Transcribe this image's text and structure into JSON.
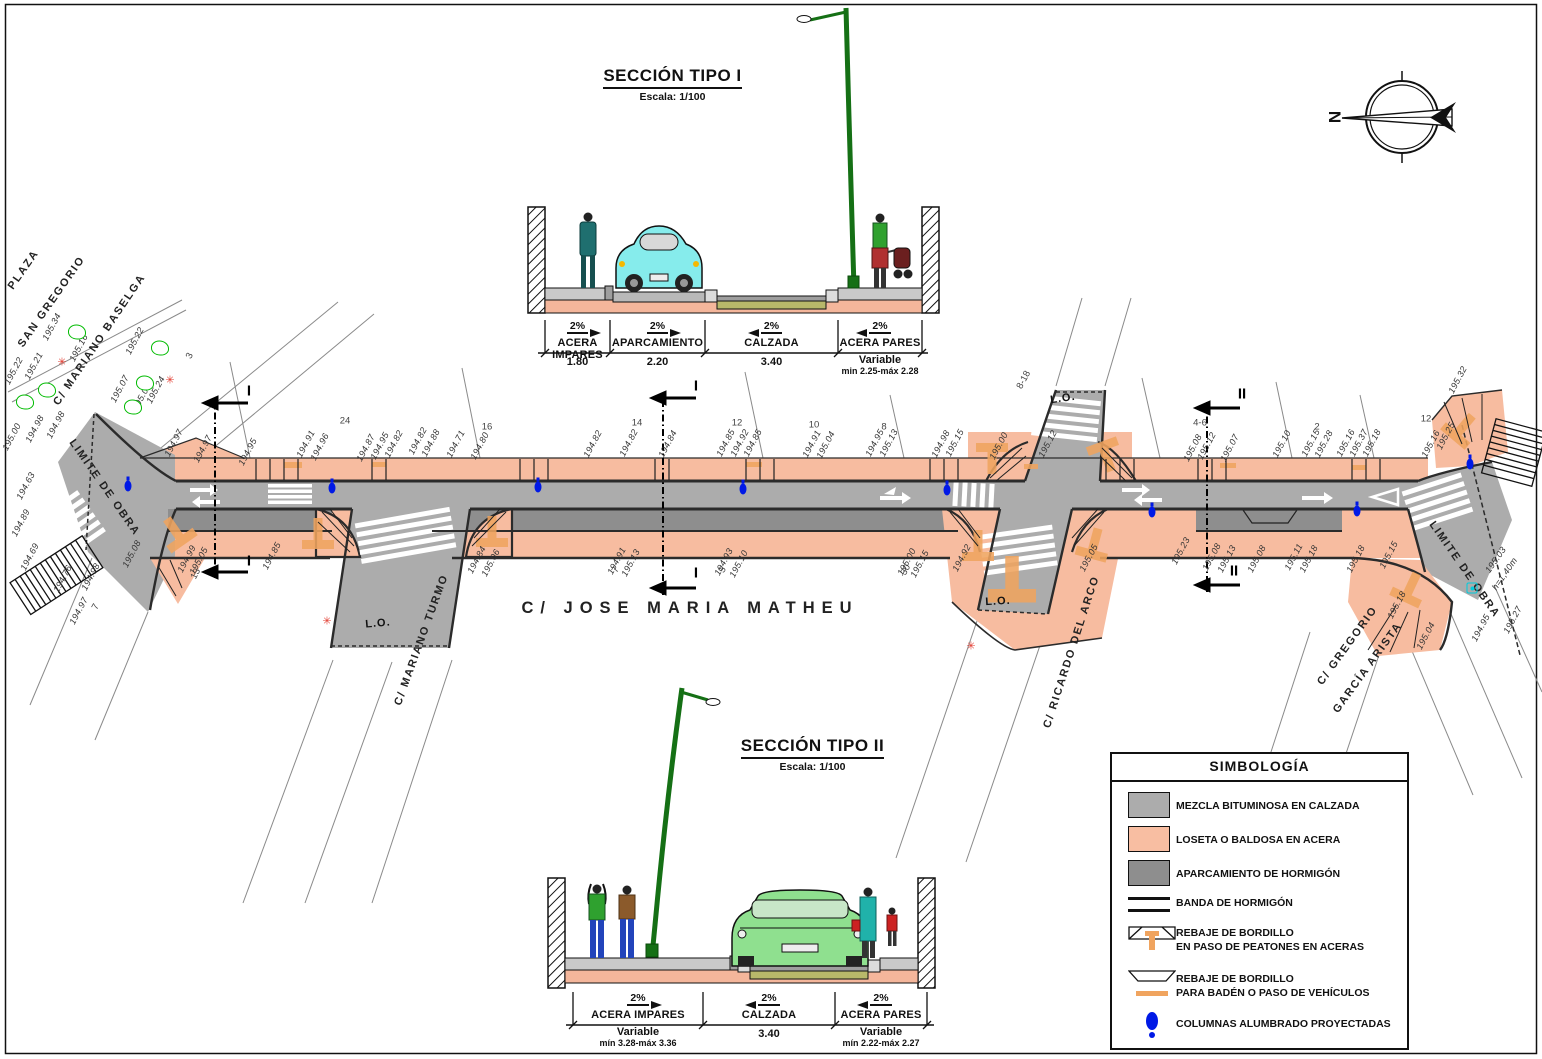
{
  "compass": {
    "letter": "N"
  },
  "colors": {
    "sidewalk": "#F7BCA0",
    "road": "#ACACAC",
    "parking": "#8E8E8E",
    "curb_cut_orange": "#F0A45F",
    "lamp_blue": "#0019E6",
    "tree_green": "#00BB00",
    "burst_red": "#E23A2E",
    "hydrant_cyan": "#00CCDD",
    "road_bed_olive": "#B8B86A"
  },
  "section1": {
    "title": "SECCIÓN TIPO I",
    "scale": "Escala: 1/100",
    "segments": [
      {
        "slope": "2%",
        "label": "ACERA IMPARES",
        "dim": "1.80"
      },
      {
        "slope": "2%",
        "label": "APARCAMIENTO",
        "dim": "2.20"
      },
      {
        "slope": "2%",
        "label": "CALZADA",
        "dim": "3.40"
      },
      {
        "slope": "2%",
        "label": "ACERA PARES",
        "dim": "Variable",
        "dim2": "min 2.25-máx 2.28"
      }
    ]
  },
  "section2": {
    "title": "SECCIÓN TIPO II",
    "scale": "Escala: 1/100",
    "segments": [
      {
        "slope": "2%",
        "label": "ACERA IMPARES",
        "dim": "Variable",
        "dim2": "mín 3.28-máx 3.36"
      },
      {
        "slope": "2%",
        "label": "CALZADA",
        "dim": "3.40"
      },
      {
        "slope": "2%",
        "label": "ACERA PARES",
        "dim": "Variable",
        "dim2": "mín 2.22-máx 2.27"
      }
    ]
  },
  "legend": {
    "title": "SIMBOLOGÍA",
    "items": [
      {
        "symbol": "road-swatch",
        "label": "MEZCLA BITUMINOSA EN CALZADA"
      },
      {
        "symbol": "sidewalk-swatch",
        "label": "LOSETA O BALDOSA EN ACERA"
      },
      {
        "symbol": "parking-swatch",
        "label": "APARCAMIENTO DE HORMIGÓN"
      },
      {
        "symbol": "band-swatch",
        "label": "BANDA DE HORMIGÓN"
      },
      {
        "symbol": "curb-ped-swatch",
        "label": "REBAJE DE BORDILLO",
        "label2": "EN PASO DE PEATONES EN ACERAS"
      },
      {
        "symbol": "curb-veh-swatch",
        "label": "REBAJE DE BORDILLO",
        "label2": "PARA BADÉN O PASO DE VEHÍCULOS"
      },
      {
        "symbol": "lamp-swatch",
        "label": "COLUMNAS ALUMBRADO PROYECTADAS"
      }
    ]
  },
  "plan": {
    "labels": [
      {
        "t": "PLAZA",
        "x": 24,
        "y": 270,
        "r": -55,
        "c": "street",
        "n": "street-label-plaza"
      },
      {
        "t": "SAN GREGORIO",
        "x": 52,
        "y": 302,
        "r": -55,
        "c": "street",
        "n": "street-label-san-gregorio"
      },
      {
        "t": "C/ MARIANO BASELGA",
        "x": 100,
        "y": 340,
        "r": -56,
        "c": "street",
        "n": "street-label-mariano-baselga"
      },
      {
        "t": "LIMITE DE OBRA",
        "x": 104,
        "y": 488,
        "r": 55,
        "c": "street",
        "n": "limite-de-obra-left"
      },
      {
        "t": "C/ MARIANO TURMO",
        "x": 422,
        "y": 640,
        "r": -70,
        "c": "street",
        "n": "street-label-mariano-turmo"
      },
      {
        "t": "C/  JOSE  MARIA  MATHEU",
        "x": 690,
        "y": 608,
        "r": 0,
        "c": "main-street",
        "n": "street-label-jose-maria-matheu"
      },
      {
        "t": "C/ RICARDO DEL ARCO",
        "x": 1072,
        "y": 652,
        "r": -72,
        "c": "street",
        "n": "street-label-ricardo-del-arco"
      },
      {
        "t": "C/ GREGORIO",
        "x": 1348,
        "y": 646,
        "r": -54,
        "c": "street",
        "n": "street-label-gregorio"
      },
      {
        "t": "GARCÍA ARISTA",
        "x": 1368,
        "y": 668,
        "r": -54,
        "c": "street",
        "n": "street-label-garcia-arista"
      },
      {
        "t": "LIMITE DE OBRA",
        "x": 1464,
        "y": 570,
        "r": 55,
        "c": "street",
        "n": "limite-de-obra-right"
      },
      {
        "t": "L.O.",
        "x": 378,
        "y": 624,
        "r": -5,
        "c": "lo"
      },
      {
        "t": "L.O.",
        "x": 1063,
        "y": 399,
        "r": -8,
        "c": "lo"
      },
      {
        "t": "L.O.",
        "x": 998,
        "y": 602,
        "r": -3,
        "c": "lo"
      },
      {
        "t": "I",
        "x": 249,
        "y": 391,
        "r": 0,
        "c": "mark",
        "n": "section-cut-mark-1"
      },
      {
        "t": "I",
        "x": 249,
        "y": 561,
        "r": 0,
        "c": "mark",
        "n": "section-cut-mark-1"
      },
      {
        "t": "I",
        "x": 696,
        "y": 386,
        "r": 0,
        "c": "mark",
        "n": "section-cut-mark-1"
      },
      {
        "t": "I",
        "x": 696,
        "y": 573,
        "r": 0,
        "c": "mark",
        "n": "section-cut-mark-1"
      },
      {
        "t": "II",
        "x": 1242,
        "y": 394,
        "r": 0,
        "c": "mark",
        "n": "section-cut-mark-2"
      },
      {
        "t": "II",
        "x": 1234,
        "y": 571,
        "r": 0,
        "c": "mark",
        "n": "section-cut-mark-2"
      },
      {
        "t": "24",
        "x": 345,
        "y": 421,
        "r": 0,
        "c": "num"
      },
      {
        "t": "16",
        "x": 487,
        "y": 427,
        "r": 0,
        "c": "num"
      },
      {
        "t": "14",
        "x": 637,
        "y": 423,
        "r": 0,
        "c": "num"
      },
      {
        "t": "12",
        "x": 737,
        "y": 423,
        "r": 0,
        "c": "num"
      },
      {
        "t": "10",
        "x": 814,
        "y": 425,
        "r": 0,
        "c": "num"
      },
      {
        "t": "8",
        "x": 884,
        "y": 427,
        "r": 0,
        "c": "num"
      },
      {
        "t": "4-6",
        "x": 1200,
        "y": 423,
        "r": 0,
        "c": "num"
      },
      {
        "t": "2",
        "x": 1317,
        "y": 427,
        "r": 0,
        "c": "num"
      },
      {
        "t": "12",
        "x": 1426,
        "y": 419,
        "r": 0,
        "c": "num"
      },
      {
        "t": "8-18",
        "x": 1024,
        "y": 380,
        "r": -62,
        "c": "num"
      },
      {
        "t": "3",
        "x": 190,
        "y": 356,
        "r": -62,
        "c": "num"
      },
      {
        "t": "13",
        "x": 196,
        "y": 574,
        "r": -62,
        "c": "num"
      },
      {
        "t": "7",
        "x": 96,
        "y": 607,
        "r": -62,
        "c": "num"
      },
      {
        "t": "7",
        "x": 616,
        "y": 570,
        "r": -62,
        "c": "num"
      },
      {
        "t": "5",
        "x": 723,
        "y": 570,
        "r": -62,
        "c": "num"
      },
      {
        "t": "30",
        "x": 906,
        "y": 570,
        "r": -62,
        "c": "num"
      },
      {
        "t": "194.97",
        "x": 174,
        "y": 443,
        "r": -62,
        "c": "elev"
      },
      {
        "t": "194.97",
        "x": 203,
        "y": 449,
        "r": -62,
        "c": "elev"
      },
      {
        "t": "194.95",
        "x": 248,
        "y": 452,
        "r": -62,
        "c": "elev"
      },
      {
        "t": "194.91",
        "x": 306,
        "y": 444,
        "r": -62,
        "c": "elev"
      },
      {
        "t": "194.96",
        "x": 320,
        "y": 447,
        "r": -62,
        "c": "elev"
      },
      {
        "t": "194.87",
        "x": 366,
        "y": 448,
        "r": -62,
        "c": "elev"
      },
      {
        "t": "194.95",
        "x": 380,
        "y": 446,
        "r": -62,
        "c": "elev"
      },
      {
        "t": "194.82",
        "x": 394,
        "y": 444,
        "r": -62,
        "c": "elev"
      },
      {
        "t": "194.82",
        "x": 418,
        "y": 441,
        "r": -62,
        "c": "elev"
      },
      {
        "t": "194.88",
        "x": 431,
        "y": 443,
        "r": -62,
        "c": "elev"
      },
      {
        "t": "194.71",
        "x": 456,
        "y": 444,
        "r": -62,
        "c": "elev"
      },
      {
        "t": "194.80",
        "x": 480,
        "y": 446,
        "r": -62,
        "c": "elev"
      },
      {
        "t": "194.82",
        "x": 593,
        "y": 444,
        "r": -62,
        "c": "elev"
      },
      {
        "t": "194.82",
        "x": 629,
        "y": 443,
        "r": -62,
        "c": "elev"
      },
      {
        "t": "194.84",
        "x": 668,
        "y": 444,
        "r": -62,
        "c": "elev"
      },
      {
        "t": "194.85",
        "x": 726,
        "y": 443,
        "r": -62,
        "c": "elev"
      },
      {
        "t": "194.92",
        "x": 740,
        "y": 443,
        "r": -62,
        "c": "elev"
      },
      {
        "t": "194.85",
        "x": 753,
        "y": 443,
        "r": -62,
        "c": "elev"
      },
      {
        "t": "194.91",
        "x": 812,
        "y": 444,
        "r": -62,
        "c": "elev"
      },
      {
        "t": "195.04",
        "x": 826,
        "y": 445,
        "r": -62,
        "c": "elev"
      },
      {
        "t": "194.95",
        "x": 875,
        "y": 443,
        "r": -62,
        "c": "elev"
      },
      {
        "t": "195.13",
        "x": 889,
        "y": 443,
        "r": -62,
        "c": "elev"
      },
      {
        "t": "194.98",
        "x": 941,
        "y": 444,
        "r": -62,
        "c": "elev"
      },
      {
        "t": "195.15",
        "x": 955,
        "y": 443,
        "r": -62,
        "c": "elev"
      },
      {
        "t": "195.00",
        "x": 999,
        "y": 446,
        "r": -62,
        "c": "elev"
      },
      {
        "t": "195.12",
        "x": 1048,
        "y": 444,
        "r": -62,
        "c": "elev"
      },
      {
        "t": "195.08",
        "x": 1193,
        "y": 448,
        "r": -62,
        "c": "elev"
      },
      {
        "t": "195.12",
        "x": 1207,
        "y": 446,
        "r": -62,
        "c": "elev"
      },
      {
        "t": "195.07",
        "x": 1230,
        "y": 448,
        "r": -62,
        "c": "elev"
      },
      {
        "t": "195.10",
        "x": 1282,
        "y": 444,
        "r": -62,
        "c": "elev"
      },
      {
        "t": "195.15",
        "x": 1311,
        "y": 443,
        "r": -62,
        "c": "elev"
      },
      {
        "t": "195.28",
        "x": 1324,
        "y": 444,
        "r": -62,
        "c": "elev"
      },
      {
        "t": "195.16",
        "x": 1346,
        "y": 443,
        "r": -62,
        "c": "elev"
      },
      {
        "t": "195.37",
        "x": 1359,
        "y": 443,
        "r": -62,
        "c": "elev"
      },
      {
        "t": "195.18",
        "x": 1372,
        "y": 443,
        "r": -62,
        "c": "elev"
      },
      {
        "t": "195.16",
        "x": 1431,
        "y": 444,
        "r": -62,
        "c": "elev"
      },
      {
        "t": "195.25",
        "x": 1446,
        "y": 436,
        "r": -62,
        "c": "elev"
      },
      {
        "t": "195.32",
        "x": 1458,
        "y": 380,
        "r": -62,
        "c": "elev"
      },
      {
        "t": "195.00",
        "x": 12,
        "y": 437,
        "r": -62,
        "c": "elev"
      },
      {
        "t": "194.98",
        "x": 35,
        "y": 429,
        "r": -62,
        "c": "elev"
      },
      {
        "t": "194.98",
        "x": 56,
        "y": 425,
        "r": -62,
        "c": "elev"
      },
      {
        "t": "195.22",
        "x": 14,
        "y": 371,
        "r": -62,
        "c": "elev"
      },
      {
        "t": "195.21",
        "x": 34,
        "y": 366,
        "r": -62,
        "c": "elev"
      },
      {
        "t": "195.34",
        "x": 52,
        "y": 327,
        "r": -62,
        "c": "elev"
      },
      {
        "t": "195.16",
        "x": 79,
        "y": 348,
        "r": -62,
        "c": "elev"
      },
      {
        "t": "195.22",
        "x": 135,
        "y": 341,
        "r": -62,
        "c": "elev"
      },
      {
        "t": "195.07",
        "x": 120,
        "y": 389,
        "r": -62,
        "c": "elev"
      },
      {
        "t": "195.06",
        "x": 142,
        "y": 397,
        "r": -62,
        "c": "elev"
      },
      {
        "t": "195.24",
        "x": 156,
        "y": 390,
        "r": -62,
        "c": "elev"
      },
      {
        "t": "194.63",
        "x": 26,
        "y": 486,
        "r": -62,
        "c": "elev"
      },
      {
        "t": "194.89",
        "x": 21,
        "y": 523,
        "r": -62,
        "c": "elev"
      },
      {
        "t": "194.69",
        "x": 30,
        "y": 557,
        "r": -62,
        "c": "elev"
      },
      {
        "t": "194.76",
        "x": 63,
        "y": 579,
        "r": -62,
        "c": "elev"
      },
      {
        "t": "194.98",
        "x": 91,
        "y": 577,
        "r": -62,
        "c": "elev"
      },
      {
        "t": "194.97",
        "x": 79,
        "y": 611,
        "r": -62,
        "c": "elev"
      },
      {
        "t": "195.08",
        "x": 132,
        "y": 554,
        "r": -62,
        "c": "elev"
      },
      {
        "t": "194.99",
        "x": 187,
        "y": 559,
        "r": -62,
        "c": "elev"
      },
      {
        "t": "195.05",
        "x": 199,
        "y": 561,
        "r": -62,
        "c": "elev"
      },
      {
        "t": "194.85",
        "x": 272,
        "y": 556,
        "r": -62,
        "c": "elev"
      },
      {
        "t": "194.84",
        "x": 477,
        "y": 560,
        "r": -62,
        "c": "elev"
      },
      {
        "t": "195.06",
        "x": 491,
        "y": 563,
        "r": -62,
        "c": "elev"
      },
      {
        "t": "194.91",
        "x": 617,
        "y": 561,
        "r": -62,
        "c": "elev"
      },
      {
        "t": "195.13",
        "x": 631,
        "y": 563,
        "r": -62,
        "c": "elev"
      },
      {
        "t": "194.93",
        "x": 724,
        "y": 562,
        "r": -62,
        "c": "elev"
      },
      {
        "t": "195.10",
        "x": 739,
        "y": 564,
        "r": -62,
        "c": "elev"
      },
      {
        "t": "195.00",
        "x": 907,
        "y": 562,
        "r": -62,
        "c": "elev"
      },
      {
        "t": "195.15",
        "x": 920,
        "y": 564,
        "r": -62,
        "c": "elev"
      },
      {
        "t": "194.92",
        "x": 962,
        "y": 558,
        "r": -62,
        "c": "elev"
      },
      {
        "t": "195.05",
        "x": 1089,
        "y": 558,
        "r": -62,
        "c": "elev"
      },
      {
        "t": "195.23",
        "x": 1181,
        "y": 551,
        "r": -62,
        "c": "elev"
      },
      {
        "t": "195.08",
        "x": 1212,
        "y": 557,
        "r": -62,
        "c": "elev"
      },
      {
        "t": "195.13",
        "x": 1227,
        "y": 559,
        "r": -62,
        "c": "elev"
      },
      {
        "t": "195.08",
        "x": 1257,
        "y": 559,
        "r": -62,
        "c": "elev"
      },
      {
        "t": "195.11",
        "x": 1294,
        "y": 557,
        "r": -62,
        "c": "elev"
      },
      {
        "t": "195.18",
        "x": 1309,
        "y": 559,
        "r": -62,
        "c": "elev"
      },
      {
        "t": "195.18",
        "x": 1356,
        "y": 559,
        "r": -62,
        "c": "elev"
      },
      {
        "t": "195.15",
        "x": 1389,
        "y": 555,
        "r": -62,
        "c": "elev"
      },
      {
        "t": "195.18",
        "x": 1397,
        "y": 605,
        "r": -62,
        "c": "elev"
      },
      {
        "t": "195.04",
        "x": 1426,
        "y": 636,
        "r": -62,
        "c": "elev"
      },
      {
        "t": "194.95",
        "x": 1481,
        "y": 628,
        "r": -62,
        "c": "elev"
      },
      {
        "t": "195.27",
        "x": 1513,
        "y": 620,
        "r": -62,
        "c": "elev"
      },
      {
        "t": "195.03",
        "x": 1496,
        "y": 560,
        "r": -55,
        "c": "elev",
        "n": "hydrant-elevation"
      },
      {
        "t": "h=1,40m",
        "x": 1505,
        "y": 574,
        "r": -55,
        "c": "elev",
        "n": "hydrant-height"
      }
    ],
    "lamps": [
      {
        "x": 128,
        "y": 486
      },
      {
        "x": 332,
        "y": 488
      },
      {
        "x": 538,
        "y": 487
      },
      {
        "x": 743,
        "y": 489
      },
      {
        "x": 947,
        "y": 490
      },
      {
        "x": 1152,
        "y": 512
      },
      {
        "x": 1357,
        "y": 511
      },
      {
        "x": 1470,
        "y": 464
      }
    ],
    "symbols": [
      {
        "k": "tree",
        "x": 77,
        "y": 332
      },
      {
        "k": "tree",
        "x": 47,
        "y": 390
      },
      {
        "k": "tree",
        "x": 25,
        "y": 402
      },
      {
        "k": "tree",
        "x": 160,
        "y": 348
      },
      {
        "k": "tree",
        "x": 145,
        "y": 383
      },
      {
        "k": "tree",
        "x": 133,
        "y": 407
      },
      {
        "k": "burst",
        "x": 62,
        "y": 363
      },
      {
        "k": "burst",
        "x": 170,
        "y": 381
      },
      {
        "k": "burst",
        "x": 327,
        "y": 622
      },
      {
        "k": "burst",
        "x": 971,
        "y": 647
      },
      {
        "k": "hydrant",
        "x": 1472,
        "y": 588
      }
    ]
  }
}
